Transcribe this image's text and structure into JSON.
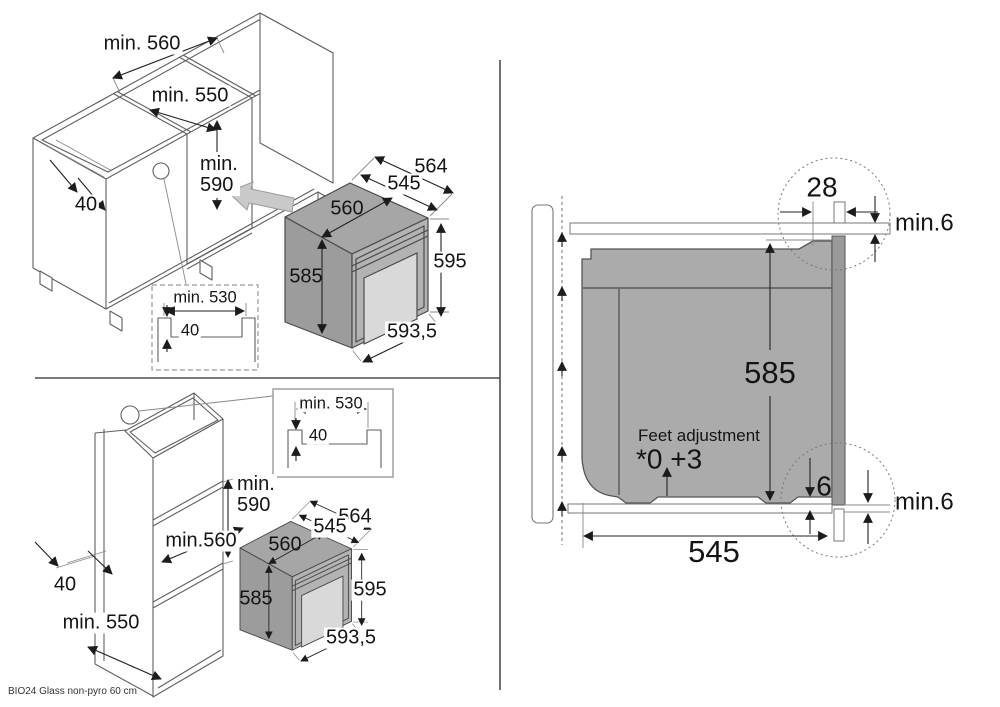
{
  "footer": {
    "model_label": "BIO24 Glass non-pyro 60 cm"
  },
  "base_cabinet_scene": {
    "dim_min560": "min. 560",
    "dim_min550": "min. 550",
    "dim_min590": "min.\n590",
    "dim_rail_40": "40",
    "detail": {
      "dim_min530": "min. 530",
      "dim_40": "40"
    },
    "oven": {
      "dim_564": "564",
      "dim_545": "545",
      "dim_560": "560",
      "dim_585": "585",
      "dim_595": "595",
      "dim_593_5": "593,5"
    }
  },
  "tall_cabinet_scene": {
    "dim_min590": "min.\n590",
    "dim_min560": "min.560",
    "dim_rail_40": "40",
    "dim_min550": "min. 550",
    "detail": {
      "dim_min530": "min. 530",
      "dim_40": "40"
    },
    "oven": {
      "dim_564": "564",
      "dim_545": "545",
      "dim_560": "560",
      "dim_585": "585",
      "dim_595": "595",
      "dim_593_5": "593,5"
    }
  },
  "section_scene": {
    "dim_28": "28",
    "dim_min6_top": "min.6",
    "dim_585": "585",
    "feet_adjustment_label": "Feet adjustment",
    "feet_adjustment_value": "*0 +3",
    "dim_6": "6",
    "dim_min6_bottom": "min.6",
    "dim_545": "545"
  }
}
